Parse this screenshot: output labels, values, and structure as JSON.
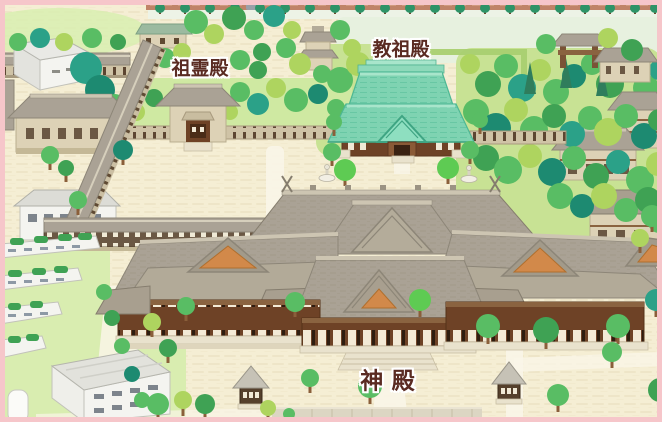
{
  "labels": {
    "soreiden": "祖霊殿",
    "kyosoden": "教祖殿",
    "shinden": "神 殿"
  },
  "colors": {
    "frame_pink": "#f6c6ca",
    "ground_cream": "#f5eed4",
    "ground_line": "#eadfbd",
    "road_brown": "#c08368",
    "lawn_green": "#cfe9a2",
    "grass_light": "#d9edb0",
    "forest_base": "#c8e294",
    "roof_taupe": "#aaa295",
    "roof_taupe_dark": "#8d8678",
    "roof_teal": "#7fd3b2",
    "roof_teal_light": "#a8e5cb",
    "gable_orange": "#d2894a",
    "wall_brown": "#6e4226",
    "wall_tan": "#ddd2b6",
    "building_white": "#f4f4f0",
    "building_gray": "#dcdcd6",
    "tree_teal": "#2ba188",
    "tree_green": "#59bd64",
    "tree_yellow_green": "#aed45f",
    "tree_bright": "#5ecb53",
    "path_white": "#f9f5e8",
    "label_text": "#5a2b22"
  }
}
